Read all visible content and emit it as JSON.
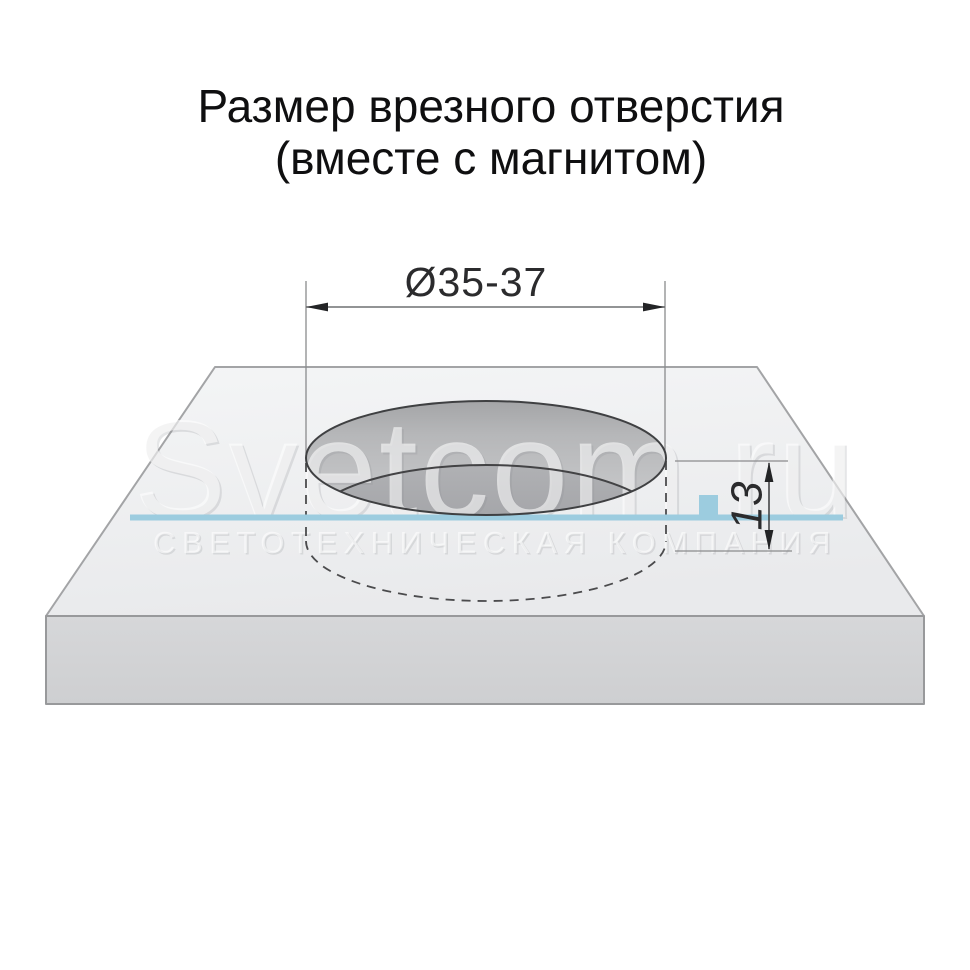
{
  "title": {
    "line1": "Размер врезного отверстия",
    "line2": "(вместе с магнитом)"
  },
  "dimensions": {
    "diameter_label": "Ø35-37",
    "depth_label": "13"
  },
  "watermark": {
    "brand": "Svetcom.ru",
    "tagline": "СВЕТОТЕХНИЧЕСКАЯ КОМПАНИЯ"
  },
  "colors": {
    "magnet_line": "#9cccdf",
    "dimension_ink": "#2b2b2d",
    "title_ink": "#0f0f10",
    "panel_top": "#eff0f2",
    "panel_front": "#d2d3d5",
    "hole_wall": "#b7b8ba",
    "hole_bottom": "#a2a3a6"
  }
}
